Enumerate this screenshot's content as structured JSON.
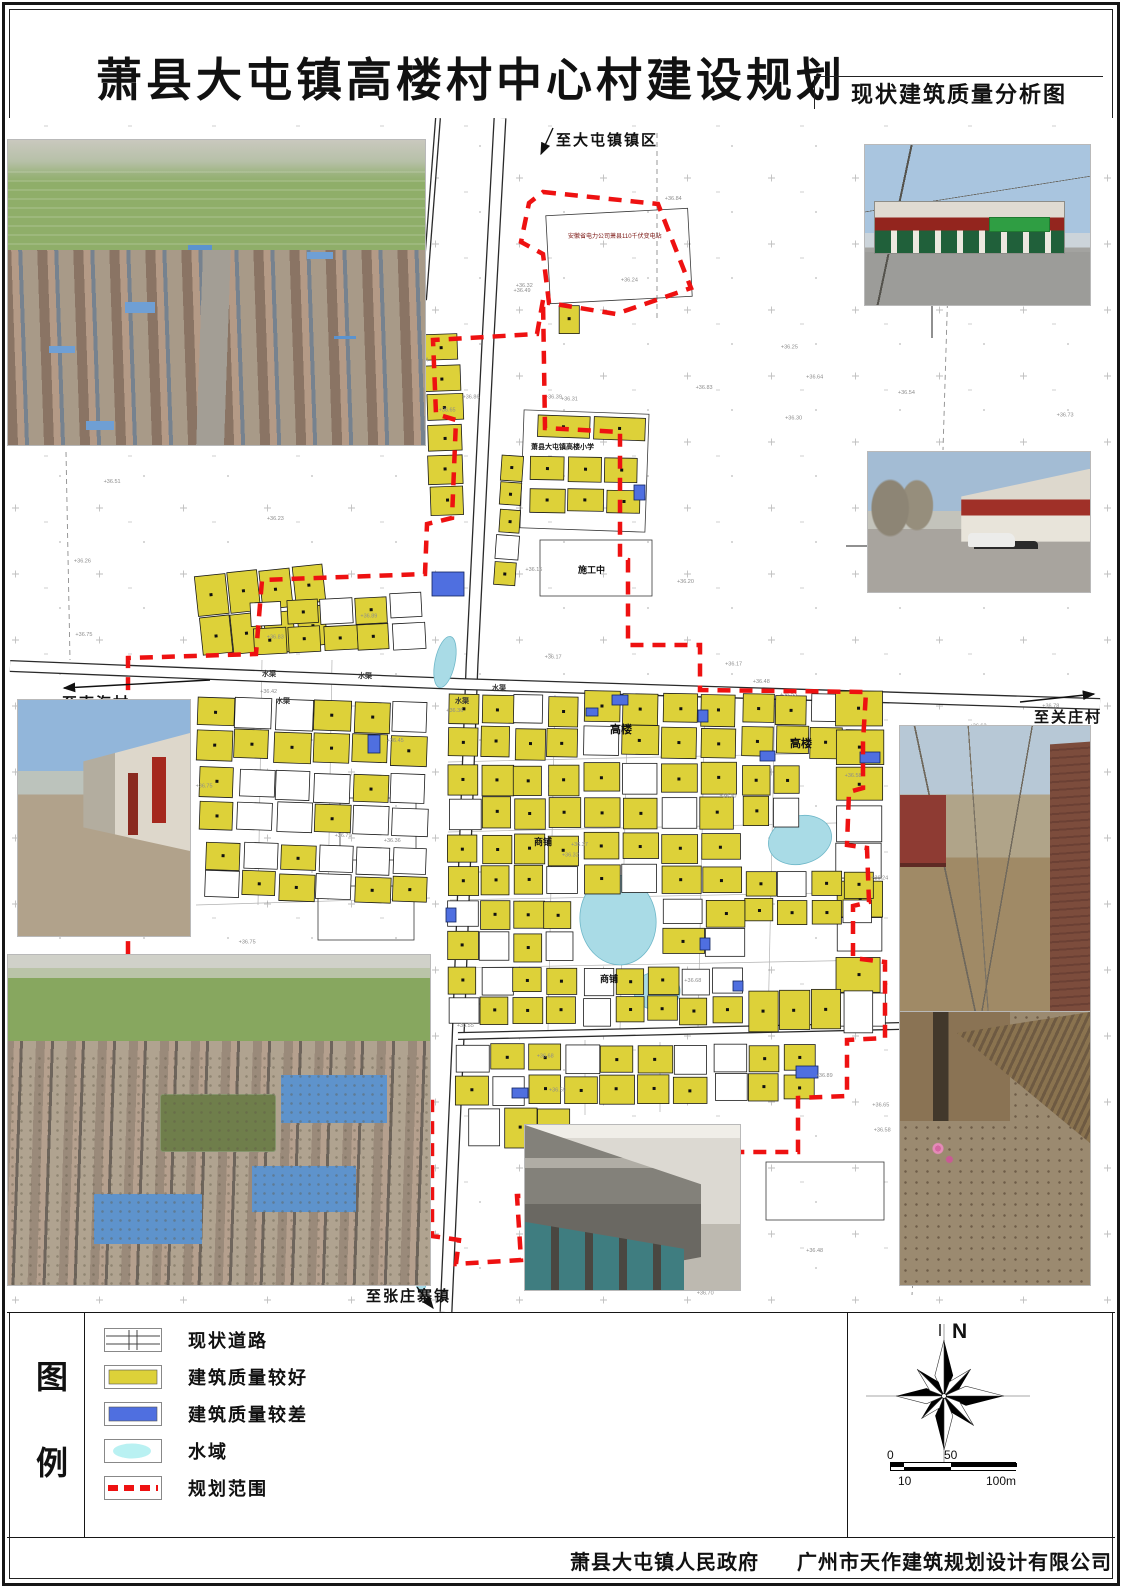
{
  "title": {
    "text": "萧县大屯镇高楼村中心村建设规划",
    "subtitle": "现状建筑质量分析图"
  },
  "footer": {
    "left": "萧县大屯镇人民政府",
    "right": "广州市天作建筑规划设计有限公司"
  },
  "legend": {
    "panel_chars": [
      "图",
      "例"
    ],
    "items": [
      {
        "key": "road",
        "label": "现状道路"
      },
      {
        "key": "good",
        "label": "建筑质量较好"
      },
      {
        "key": "poor",
        "label": "建筑质量较差"
      },
      {
        "key": "water",
        "label": "水域"
      },
      {
        "key": "boundary",
        "label": "规划范围"
      }
    ]
  },
  "compass": {
    "label": "N"
  },
  "scalebar": {
    "top": [
      "0",
      "50"
    ],
    "bottom": [
      "10",
      "100m"
    ]
  },
  "colors": {
    "good": "#ddd139",
    "poor": "#4f6fe0",
    "water": "#a9dbe6",
    "water_legend": "#b9f1f2",
    "boundary": "#ee1111"
  },
  "map": {
    "labels": [
      {
        "t": "至大屯镇镇区",
        "x": 556,
        "y": 145,
        "s": 15,
        "b": 1
      },
      {
        "t": "至南海村",
        "x": 62,
        "y": 708,
        "s": 15,
        "b": 1
      },
      {
        "t": "至关庄村",
        "x": 1034,
        "y": 722,
        "s": 15,
        "b": 1
      },
      {
        "t": "至张庄寨镇",
        "x": 366,
        "y": 1301,
        "s": 15,
        "b": 1
      },
      {
        "t": "高楼",
        "x": 610,
        "y": 733,
        "s": 11,
        "b": 1
      },
      {
        "t": "高楼",
        "x": 790,
        "y": 747,
        "s": 11,
        "b": 1
      },
      {
        "t": "商铺",
        "x": 534,
        "y": 845,
        "s": 9,
        "b": 1
      },
      {
        "t": "商铺",
        "x": 600,
        "y": 982,
        "s": 9,
        "b": 1
      },
      {
        "t": "施工中",
        "x": 578,
        "y": 573,
        "s": 9,
        "b": 1
      },
      {
        "t": "萧县大屯镇高楼小学",
        "x": 531,
        "y": 449,
        "s": 7,
        "b": 1
      },
      {
        "t": "安徽省电力公司萧县110千伏变电站",
        "x": 568,
        "y": 238,
        "s": 6,
        "b": 0,
        "c": "#7a1410"
      }
    ],
    "canal_label": "水渠",
    "canal_positions": [
      [
        262,
        676
      ],
      [
        358,
        678
      ],
      [
        492,
        690
      ],
      [
        276,
        703
      ],
      [
        455,
        703
      ]
    ],
    "arrows": [
      [
        553,
        128,
        541,
        154
      ],
      [
        210,
        680,
        64,
        688
      ],
      [
        1020,
        702,
        1094,
        694
      ],
      [
        417,
        1287,
        433,
        1308
      ]
    ],
    "leaders": [
      [
        932,
        305,
        932,
        338
      ],
      [
        868,
        546,
        846,
        546
      ]
    ],
    "roads": [
      {
        "pts": [
          [
            500,
            118
          ],
          [
            488,
            340
          ],
          [
            472,
            665
          ],
          [
            458,
            1040
          ],
          [
            446,
            1312
          ]
        ],
        "w": 13
      },
      {
        "pts": [
          [
            10,
            666
          ],
          [
            460,
            684
          ],
          [
            1100,
            704
          ]
        ],
        "w": 12
      },
      {
        "pts": [
          [
            458,
            1036
          ],
          [
            900,
            1026
          ]
        ],
        "w": 8
      },
      {
        "pts": [
          [
            438,
            118
          ],
          [
            424,
            300
          ]
        ],
        "w": 6
      }
    ],
    "lanes": [
      [
        555,
        695,
        548,
        1030
      ],
      [
        628,
        693,
        620,
        1030
      ],
      [
        705,
        695,
        698,
        1028
      ],
      [
        775,
        697,
        768,
        1028
      ],
      [
        448,
        762,
        878,
        752
      ],
      [
        448,
        832,
        878,
        822
      ],
      [
        450,
        900,
        878,
        892
      ],
      [
        452,
        968,
        876,
        960
      ],
      [
        262,
        660,
        258,
        905
      ],
      [
        332,
        660,
        328,
        900
      ],
      [
        196,
        905,
        430,
        898
      ],
      [
        585,
        1040,
        585,
        1115
      ],
      [
        660,
        1042,
        660,
        1112
      ]
    ],
    "outlines": [
      [
        522,
        412,
        125,
        118,
        2
      ],
      [
        548,
        212,
        142,
        88,
        -3
      ],
      [
        540,
        540,
        112,
        56,
        0
      ],
      [
        340,
        798,
        76,
        62,
        0
      ],
      [
        318,
        886,
        96,
        54,
        0
      ],
      [
        766,
        1162,
        118,
        58,
        0
      ]
    ],
    "ponds": [
      [
        618,
        920,
        38,
        45,
        -8
      ],
      [
        657,
        991,
        23,
        19,
        0
      ],
      [
        800,
        840,
        32,
        24,
        -15
      ],
      [
        445,
        662,
        10,
        26,
        12
      ],
      [
        422,
        1268,
        7,
        24,
        3
      ]
    ],
    "blocks": [
      [
        198,
        570,
        128,
        82,
        2,
        4,
        -6,
        0.85
      ],
      [
        252,
        598,
        172,
        52,
        2,
        5,
        -3,
        0.6
      ],
      [
        427,
        334,
        34,
        180,
        6,
        1,
        -2,
        0.85
      ],
      [
        499,
        455,
        21,
        132,
        5,
        1,
        4,
        0.95
      ],
      [
        538,
        417,
        106,
        22,
        1,
        2,
        2,
        0.95
      ],
      [
        530,
        458,
        110,
        24,
        1,
        3,
        1,
        1.0
      ],
      [
        530,
        490,
        110,
        22,
        1,
        3,
        1,
        0.9
      ],
      [
        560,
        306,
        20,
        26,
        1,
        1,
        0,
        1.0
      ],
      [
        196,
        700,
        232,
        62,
        2,
        6,
        2,
        0.55
      ],
      [
        200,
        772,
        226,
        60,
        2,
        6,
        2,
        0.5
      ],
      [
        205,
        845,
        222,
        55,
        2,
        6,
        2,
        0.45
      ],
      [
        448,
        695,
        130,
        62,
        2,
        4,
        1,
        0.8
      ],
      [
        585,
        693,
        150,
        64,
        2,
        4,
        1,
        0.75
      ],
      [
        742,
        695,
        135,
        62,
        2,
        4,
        1,
        0.8
      ],
      [
        448,
        765,
        130,
        62,
        2,
        4,
        0,
        0.75
      ],
      [
        585,
        763,
        150,
        64,
        2,
        4,
        0,
        0.7
      ],
      [
        742,
        765,
        58,
        62,
        2,
        2,
        0,
        0.8
      ],
      [
        836,
        692,
        46,
        336,
        9,
        1,
        0,
        0.85
      ],
      [
        448,
        835,
        130,
        60,
        2,
        4,
        0,
        0.7
      ],
      [
        585,
        833,
        72,
        58,
        2,
        2,
        0,
        0.7
      ],
      [
        662,
        835,
        78,
        58,
        2,
        2,
        0,
        0.7
      ],
      [
        745,
        872,
        128,
        52,
        2,
        4,
        0,
        0.75
      ],
      [
        448,
        902,
        126,
        58,
        2,
        4,
        0,
        0.7
      ],
      [
        662,
        900,
        84,
        56,
        2,
        2,
        0,
        0.7
      ],
      [
        448,
        968,
        128,
        55,
        2,
        4,
        0,
        0.75
      ],
      [
        584,
        968,
        158,
        55,
        2,
        5,
        0,
        0.7
      ],
      [
        748,
        990,
        124,
        40,
        1,
        4,
        0,
        0.8
      ],
      [
        455,
        1045,
        252,
        58,
        2,
        7,
        0,
        0.7
      ],
      [
        715,
        1045,
        100,
        55,
        2,
        3,
        0,
        0.6
      ],
      [
        470,
        1108,
        100,
        38,
        1,
        3,
        0,
        0.6
      ]
    ],
    "poor_buildings": [
      [
        432,
        572,
        32,
        24
      ],
      [
        634,
        485,
        11,
        15
      ],
      [
        612,
        695,
        16,
        10
      ],
      [
        760,
        751,
        15,
        10
      ],
      [
        698,
        710,
        10,
        12
      ],
      [
        586,
        708,
        12,
        8
      ],
      [
        860,
        752,
        20,
        11
      ],
      [
        512,
        1088,
        16,
        10
      ],
      [
        796,
        1066,
        22,
        12
      ],
      [
        446,
        908,
        10,
        14
      ],
      [
        700,
        938,
        10,
        12
      ],
      [
        733,
        981,
        10,
        10
      ],
      [
        694,
        1128,
        18,
        11
      ],
      [
        368,
        735,
        12,
        18
      ]
    ],
    "boundary_main": [
      [
        543,
        300
      ],
      [
        537,
        334
      ],
      [
        433,
        340
      ],
      [
        436,
        414
      ],
      [
        456,
        420
      ],
      [
        452,
        518
      ],
      [
        427,
        524
      ],
      [
        425,
        574
      ],
      [
        262,
        580
      ],
      [
        256,
        654
      ],
      [
        128,
        658
      ],
      [
        128,
        1102
      ],
      [
        432,
        1102
      ],
      [
        432,
        1236
      ],
      [
        459,
        1240
      ],
      [
        456,
        1264
      ],
      [
        521,
        1260
      ],
      [
        517,
        1196
      ],
      [
        637,
        1192
      ],
      [
        637,
        1152
      ],
      [
        798,
        1152
      ],
      [
        798,
        1098
      ],
      [
        847,
        1096
      ],
      [
        847,
        1040
      ],
      [
        885,
        1038
      ],
      [
        885,
        962
      ],
      [
        853,
        958
      ],
      [
        853,
        906
      ],
      [
        869,
        902
      ],
      [
        867,
        848
      ],
      [
        847,
        845
      ],
      [
        849,
        792
      ],
      [
        863,
        788
      ],
      [
        863,
        742
      ],
      [
        866,
        692
      ],
      [
        700,
        690
      ],
      [
        700,
        645
      ],
      [
        628,
        645
      ],
      [
        628,
        560
      ],
      [
        620,
        558
      ],
      [
        620,
        432
      ],
      [
        545,
        428
      ]
    ],
    "boundary_sub": [
      [
        543,
        192
      ],
      [
        658,
        204
      ],
      [
        691,
        288
      ],
      [
        616,
        314
      ],
      [
        549,
        303
      ],
      [
        543,
        254
      ],
      [
        521,
        242
      ],
      [
        529,
        203
      ]
    ],
    "gray_dashes": [
      [
        66,
        452,
        70,
        660
      ],
      [
        945,
        735,
        912,
        1295
      ],
      [
        657,
        133,
        657,
        318
      ],
      [
        952,
        150,
        943,
        450
      ]
    ],
    "elevation_prefix": "36.",
    "elevation_count": 88
  }
}
